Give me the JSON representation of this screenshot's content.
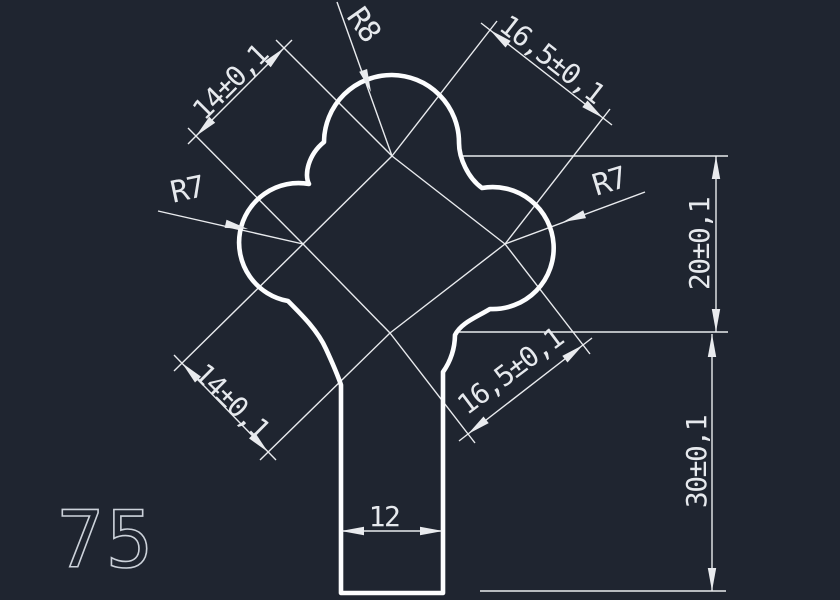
{
  "app": {
    "background_color": "#1f2530",
    "outline_color": "#fcfdfe",
    "thin_line_color": "#e9ebee",
    "text_color": "#e6e9ed",
    "part_number_color": "#ccd2da"
  },
  "part": {
    "number": "75",
    "stem_width_label": "12",
    "radii": [
      "R8",
      "R7",
      "R7"
    ],
    "tolerance_dims": [
      "14±0,1",
      "16,5±0,1",
      "14±0,1",
      "16,5±0,1",
      "20±0,1",
      "30±0,1"
    ]
  },
  "drawing": {
    "outline_path": "M 341 593 L 341 385 C 337 373 332 362 326 349 C 318 331 303 316 288 301 A 59 59 0 0 1 309 184 C 304 175 308 155 324 142 A 66 66 0 0 1 459 143 C 459 158 468 178 482 188 A 61 61 0 1 1 490 309 C 475 318 461 323 455 335 A 66 66 0 0 1 443 372 L 443 593 Z",
    "thin_lines": [
      {
        "name": "centerline-top-right",
        "x1": 392,
        "y1": 156,
        "x2": 505,
        "y2": 244
      },
      {
        "name": "centerline-right-bottom",
        "x1": 505,
        "y1": 244,
        "x2": 390,
        "y2": 333
      },
      {
        "name": "centerline-bottom-left",
        "x1": 390,
        "y1": 333,
        "x2": 303,
        "y2": 244
      },
      {
        "name": "centerline-left-top",
        "x1": 303,
        "y1": 244,
        "x2": 392,
        "y2": 156
      },
      {
        "name": "ext-line",
        "x1": 303,
        "y1": 244,
        "x2": 188,
        "y2": 128
      },
      {
        "name": "ext-line",
        "x1": 392,
        "y1": 156,
        "x2": 276,
        "y2": 40
      },
      {
        "name": "dim-line-top-left",
        "x1": 188,
        "y1": 144,
        "x2": 292,
        "y2": 40
      },
      {
        "name": "ext-line",
        "x1": 392,
        "y1": 156,
        "x2": 497,
        "y2": 21
      },
      {
        "name": "ext-line",
        "x1": 505,
        "y1": 244,
        "x2": 610,
        "y2": 109
      },
      {
        "name": "dim-line-top-right",
        "x1": 481,
        "y1": 23,
        "x2": 612,
        "y2": 125
      },
      {
        "name": "ext-line",
        "x1": 303,
        "y1": 244,
        "x2": 174,
        "y2": 371
      },
      {
        "name": "ext-line",
        "x1": 390,
        "y1": 333,
        "x2": 260,
        "y2": 460
      },
      {
        "name": "dim-line-bottom-left",
        "x1": 174,
        "y1": 355,
        "x2": 276,
        "y2": 460
      },
      {
        "name": "ext-line",
        "x1": 390,
        "y1": 333,
        "x2": 475,
        "y2": 443
      },
      {
        "name": "ext-line",
        "x1": 505,
        "y1": 244,
        "x2": 590,
        "y2": 354
      },
      {
        "name": "dim-line-bottom-right",
        "x1": 459,
        "y1": 441,
        "x2": 592,
        "y2": 338
      },
      {
        "name": "ext-line",
        "x1": 460,
        "y1": 156,
        "x2": 728,
        "y2": 156
      },
      {
        "name": "ext-line",
        "x1": 457,
        "y1": 332,
        "x2": 728,
        "y2": 332
      },
      {
        "name": "dim-line-20",
        "x1": 716,
        "y1": 156,
        "x2": 716,
        "y2": 332
      },
      {
        "name": "dim-line-30",
        "x1": 712,
        "y1": 334,
        "x2": 712,
        "y2": 591
      },
      {
        "name": "ext-line",
        "x1": 480,
        "y1": 591,
        "x2": 726,
        "y2": 591
      },
      {
        "name": "dim-line-12",
        "x1": 341,
        "y1": 531,
        "x2": 443,
        "y2": 531
      },
      {
        "name": "leader-r8",
        "x1": 337,
        "y1": 2,
        "x2": 392,
        "y2": 156
      },
      {
        "name": "leader-r7-left",
        "x1": 158,
        "y1": 211,
        "x2": 303,
        "y2": 244
      },
      {
        "name": "leader-r7-right",
        "x1": 505,
        "y1": 244,
        "x2": 645,
        "y2": 192
      }
    ],
    "arrows": [
      {
        "tip": [
          196,
          136
        ],
        "ang": 135
      },
      {
        "tip": [
          284,
          48
        ],
        "ang": -45
      },
      {
        "tip": [
          490,
          30
        ],
        "ang": -142
      },
      {
        "tip": [
          603,
          118
        ],
        "ang": 38
      },
      {
        "tip": [
          182,
          363
        ],
        "ang": -134
      },
      {
        "tip": [
          268,
          452
        ],
        "ang": 46
      },
      {
        "tip": [
          468,
          434
        ],
        "ang": 142
      },
      {
        "tip": [
          583,
          345
        ],
        "ang": -38
      },
      {
        "tip": [
          716,
          156
        ],
        "ang": -90
      },
      {
        "tip": [
          716,
          332
        ],
        "ang": 90
      },
      {
        "tip": [
          712,
          334
        ],
        "ang": -90
      },
      {
        "tip": [
          712,
          591
        ],
        "ang": 90
      },
      {
        "tip": [
          341,
          531
        ],
        "ang": 180
      },
      {
        "tip": [
          443,
          531
        ],
        "ang": 0
      },
      {
        "tip": [
          371,
          92
        ],
        "ang": 70
      },
      {
        "tip": [
          248,
          229
        ],
        "ang": 13
      },
      {
        "tip": [
          563,
          222
        ],
        "ang": 160
      }
    ],
    "labels": [
      {
        "name": "dim-label-top-left",
        "text": "14±0,1",
        "x": 230,
        "y": 82,
        "rot": -45,
        "size": 28
      },
      {
        "name": "dim-label-top-right",
        "text": "16,5±0,1",
        "x": 552,
        "y": 59,
        "rot": 38,
        "size": 28
      },
      {
        "name": "dim-label-bottom-left",
        "text": "14±0,1",
        "x": 232,
        "y": 401,
        "rot": 45,
        "size": 28
      },
      {
        "name": "dim-label-bottom-right",
        "text": "16,5±0,1",
        "x": 510,
        "y": 371,
        "rot": -37,
        "size": 28
      },
      {
        "name": "dim-label-20",
        "text": "20±0,1",
        "x": 699,
        "y": 244,
        "rot": -90,
        "size": 28
      },
      {
        "name": "dim-label-30",
        "text": "30±0,1",
        "x": 696,
        "y": 462,
        "rot": -90,
        "size": 28
      },
      {
        "name": "dim-label-12",
        "text": "12",
        "x": 384,
        "y": 516,
        "rot": 0,
        "size": 28
      },
      {
        "name": "radius-label-top",
        "text": "R8",
        "x": 364,
        "y": 24,
        "rot": 55,
        "size": 30
      },
      {
        "name": "radius-label-left",
        "text": "R7",
        "x": 187,
        "y": 189,
        "rot": -12,
        "size": 30
      },
      {
        "name": "radius-label-right",
        "text": "R7",
        "x": 609,
        "y": 181,
        "rot": -17,
        "size": 30
      }
    ],
    "part_number_label": {
      "name": "part-number",
      "text": "75",
      "x": 106,
      "y": 567,
      "size": 78
    }
  }
}
